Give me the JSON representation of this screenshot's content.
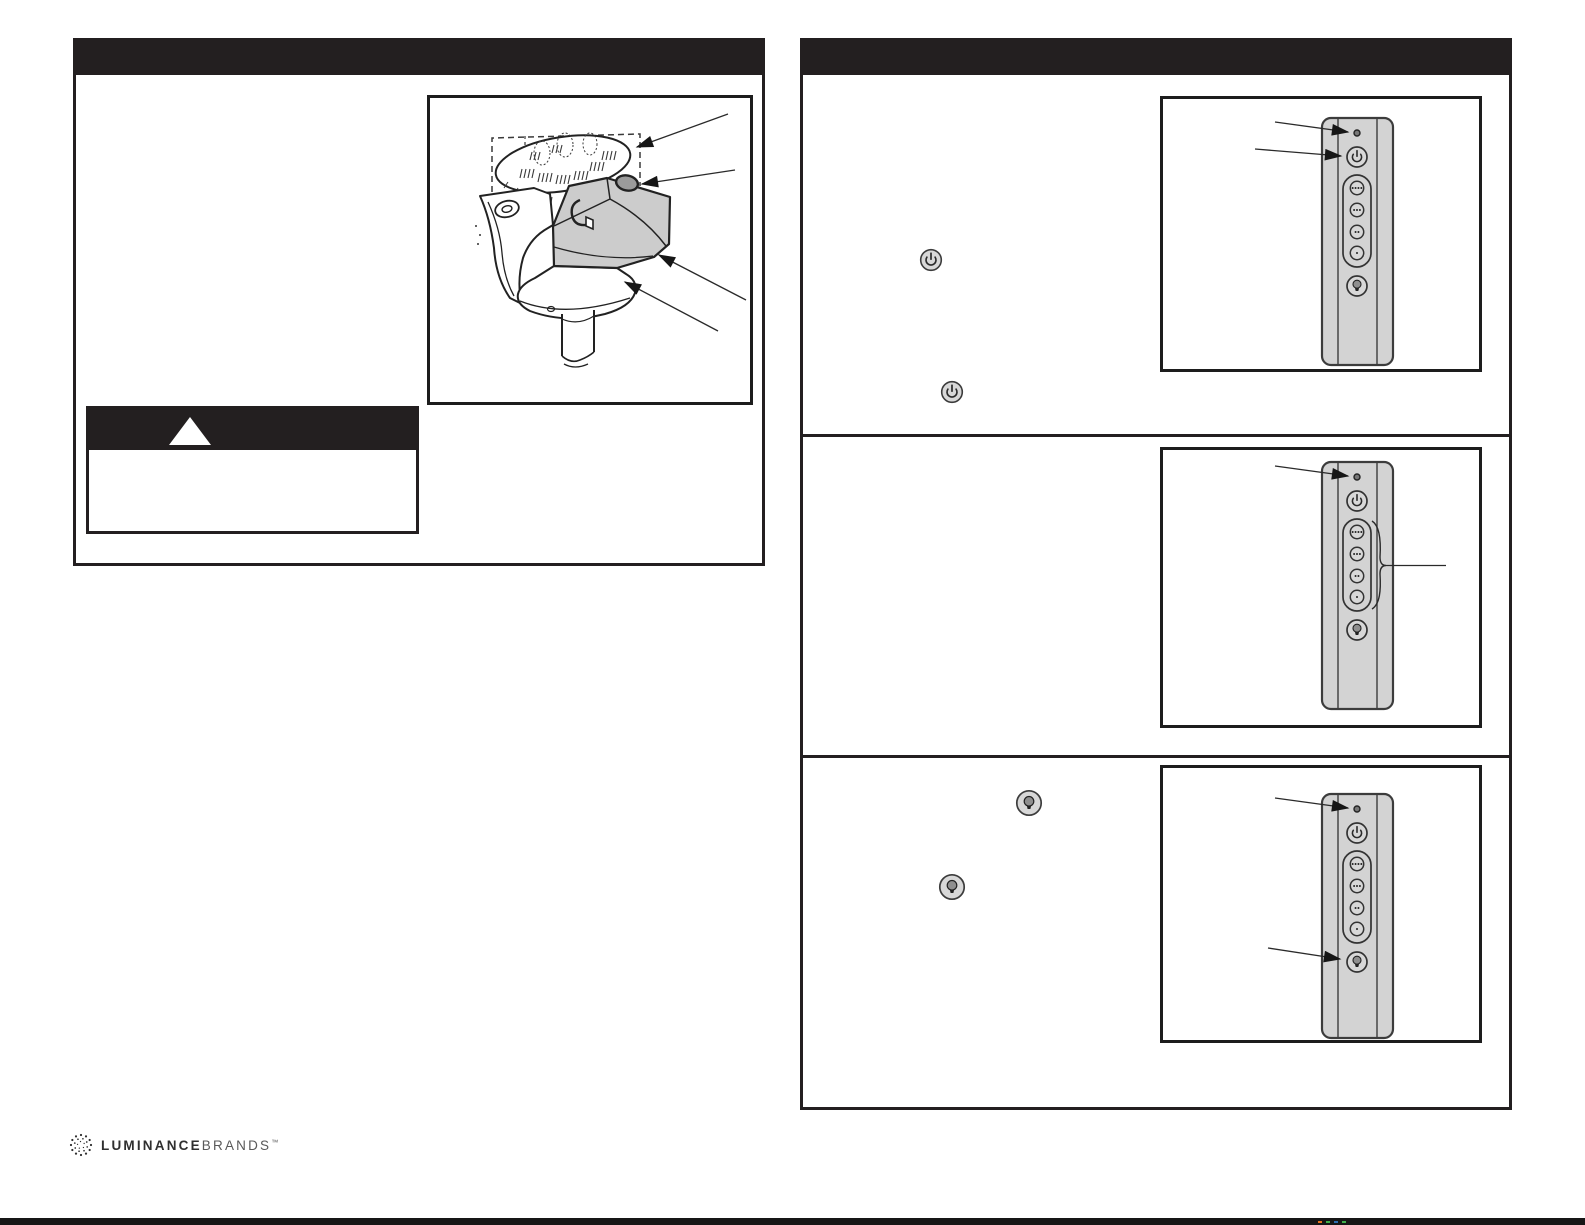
{
  "page": {
    "width": 1585,
    "height": 1225,
    "background": "#ffffff"
  },
  "colors": {
    "header_bar": "#231f20",
    "frame_border": "#1d1d1d",
    "remote_body": "#d3d3d3",
    "remote_outline": "#3c3c3c",
    "button_fill": "#d8d8d8",
    "glyph": "#2b2b2b",
    "receiver_fill": "#cccccc",
    "knob_fill": "#9b9b9b",
    "led_fill": "#777777"
  },
  "left_panel": {
    "header": {
      "text": ""
    },
    "figure": {
      "name": "receiver-installation-figure",
      "parts": [
        "ceiling-insulation",
        "mounting-bracket",
        "receiver-box",
        "antenna-knob",
        "canopy",
        "downrod"
      ],
      "callout_arrows": 4
    },
    "warning_box": {
      "icon": "warning-triangle",
      "header_text": "",
      "body_text": ""
    }
  },
  "right_panel": {
    "header": {
      "text": ""
    },
    "sections": [
      {
        "name": "power-section",
        "inline_icons": [
          "power-button-icon",
          "power-button-icon"
        ],
        "callouts": [
          "led-indicator",
          "power-button"
        ]
      },
      {
        "name": "speed-section",
        "inline_icons": [],
        "callouts": [
          "led-indicator",
          "speed-buttons-group"
        ]
      },
      {
        "name": "light-section",
        "inline_icons": [
          "light-button-icon",
          "light-button-icon"
        ],
        "callouts": [
          "led-indicator",
          "light-button"
        ]
      }
    ],
    "remote": {
      "indicator": "led-indicator",
      "buttons": [
        "power-button",
        "speed-4-button",
        "speed-3-button",
        "speed-2-button",
        "speed-1-button",
        "light-button"
      ]
    }
  },
  "footer": {
    "logo": {
      "icon": "starburst-logo-icon",
      "text_bold": "LUMINANCE",
      "text_light": "BRANDS",
      "trademark": "™"
    },
    "registration_marks": [
      "#e8731d",
      "#3fae49",
      "#2b6cb0",
      "#3fae49"
    ]
  }
}
